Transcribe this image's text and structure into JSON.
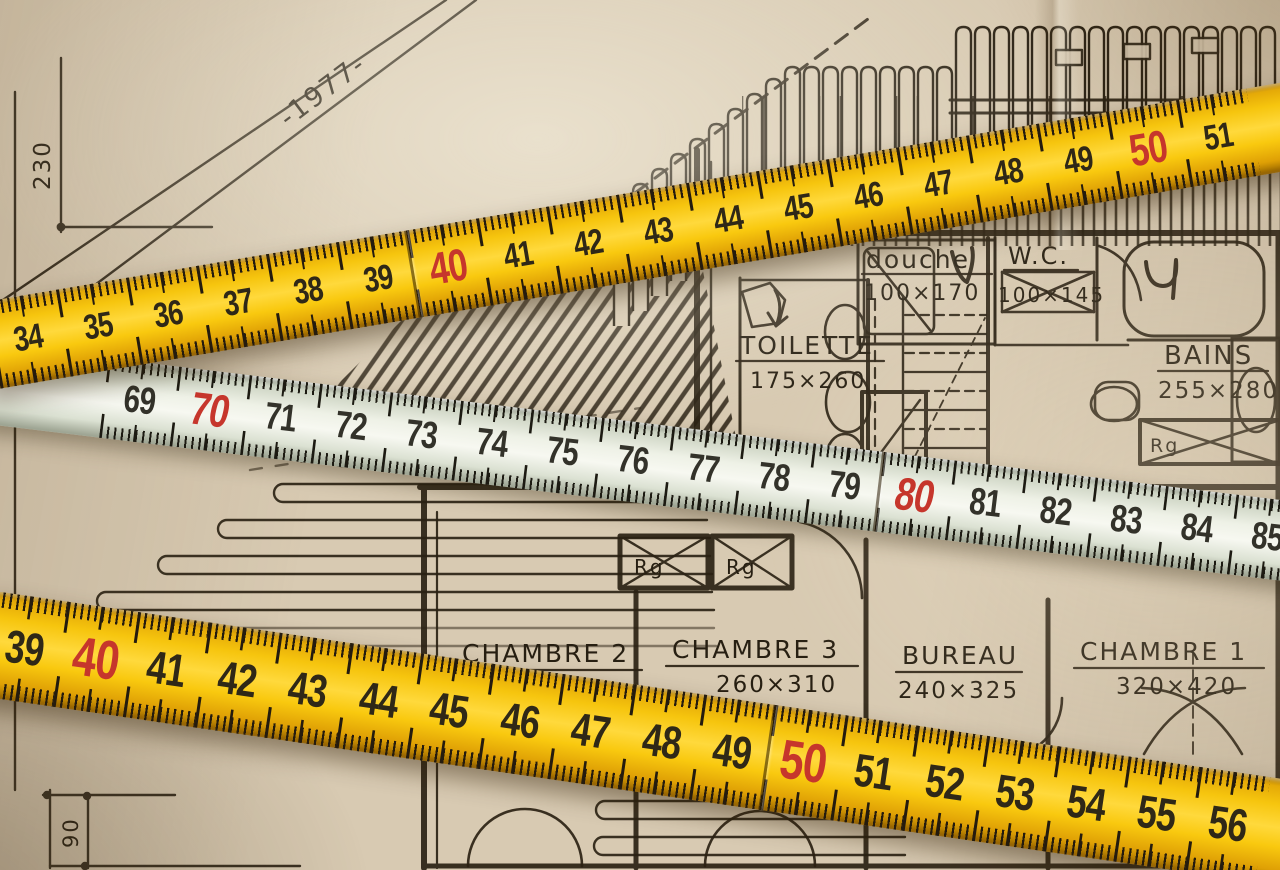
{
  "colors": {
    "paper": "#d8cab2",
    "ink": "#2b2214",
    "ruler_yellow": "#f6c50e",
    "ruler_white": "#eef1e6",
    "number_dark": "#2f2817",
    "number_red": "#c6362c"
  },
  "rulers": {
    "top": {
      "style": "yellow folding rule",
      "numbers": [
        "34",
        "35",
        "36",
        "37",
        "38",
        "39",
        "40",
        "41",
        "42",
        "43",
        "44",
        "45",
        "46",
        "47",
        "48",
        "49",
        "50",
        "51"
      ],
      "red_numbers": [
        "40",
        "50"
      ],
      "joint_numbers": [
        "40"
      ]
    },
    "middle": {
      "style": "pale folding rule",
      "numbers": [
        "69",
        "70",
        "71",
        "72",
        "73",
        "74",
        "75",
        "76",
        "77",
        "78",
        "79",
        "80",
        "81",
        "82",
        "83",
        "84",
        "85"
      ],
      "red_numbers": [
        "70",
        "80"
      ],
      "joint_numbers": [
        "80"
      ]
    },
    "bottom": {
      "style": "yellow folding rule",
      "numbers": [
        "39",
        "40",
        "41",
        "42",
        "43",
        "44",
        "45",
        "46",
        "47",
        "48",
        "49",
        "50",
        "51",
        "52",
        "53",
        "54",
        "55",
        "56"
      ],
      "red_numbers": [
        "40",
        "50"
      ],
      "joint_numbers": [
        "50"
      ]
    }
  },
  "plan": {
    "year_label": "-1977-",
    "dim_vertical_left": "230",
    "dim_vertical_bottom": "90",
    "closet_label": "Rg",
    "rooms": [
      {
        "name": "douche",
        "size": "100×170"
      },
      {
        "name": "W.C.",
        "size": "100×145"
      },
      {
        "name": "TOILETTE",
        "size": "175×260"
      },
      {
        "name": "BAINS",
        "size": "255×280"
      },
      {
        "name": "CHAMBRE 2"
      },
      {
        "name": "CHAMBRE 3",
        "size": "260×310"
      },
      {
        "name": "BUREAU",
        "size": "240×325"
      },
      {
        "name": "CHAMBRE 1",
        "size": "320×420"
      }
    ]
  }
}
